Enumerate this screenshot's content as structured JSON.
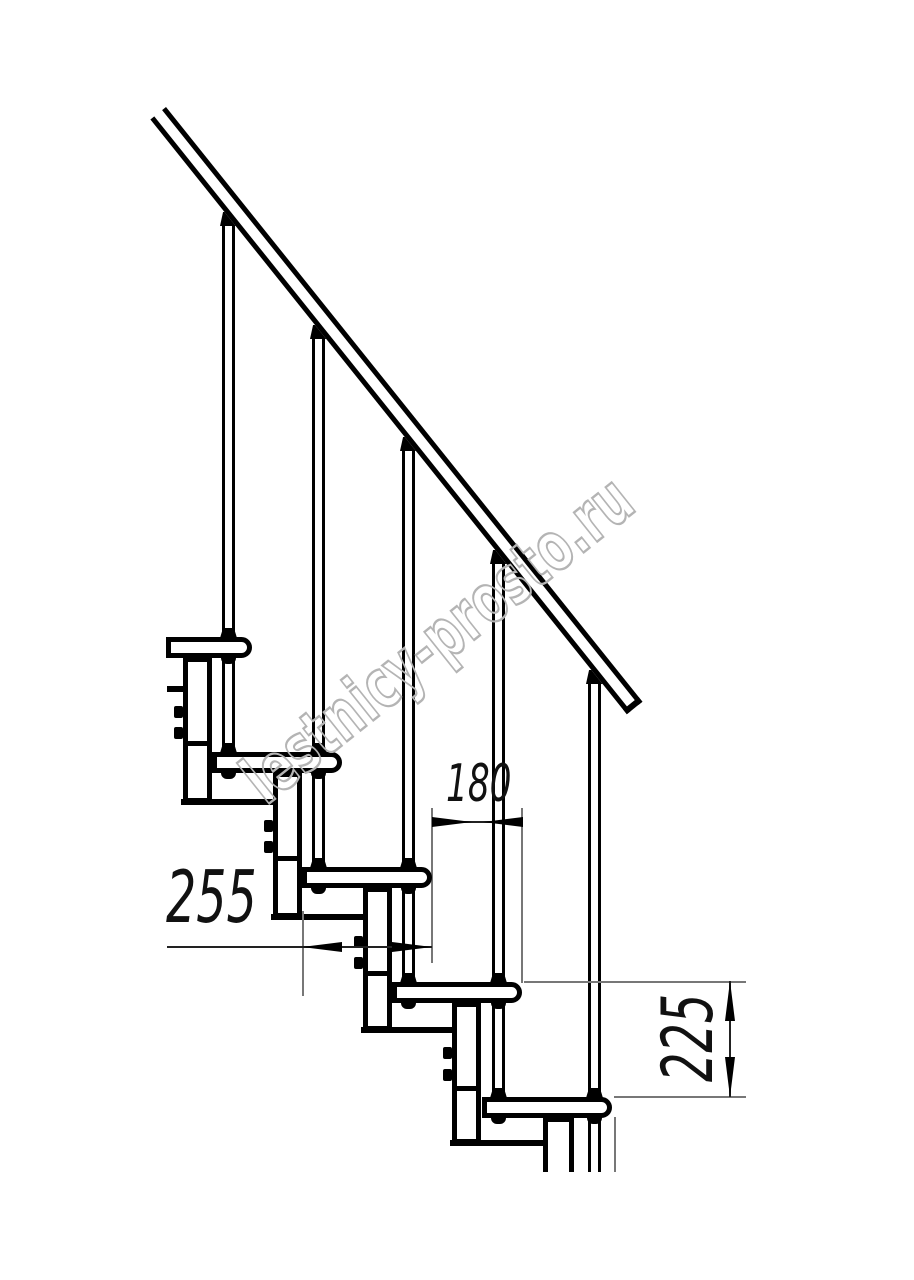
{
  "figure": {
    "type": "technical-drawing",
    "subject": "modular staircase side elevation with step dimensions",
    "background_color": "#ffffff",
    "line_color": "#000000"
  },
  "dimensions": {
    "step_run": "180",
    "tread_depth": "255",
    "step_rise": "225"
  },
  "watermark": {
    "text": "lestnicy-prosto.ru",
    "color": "#b4b4b4"
  }
}
